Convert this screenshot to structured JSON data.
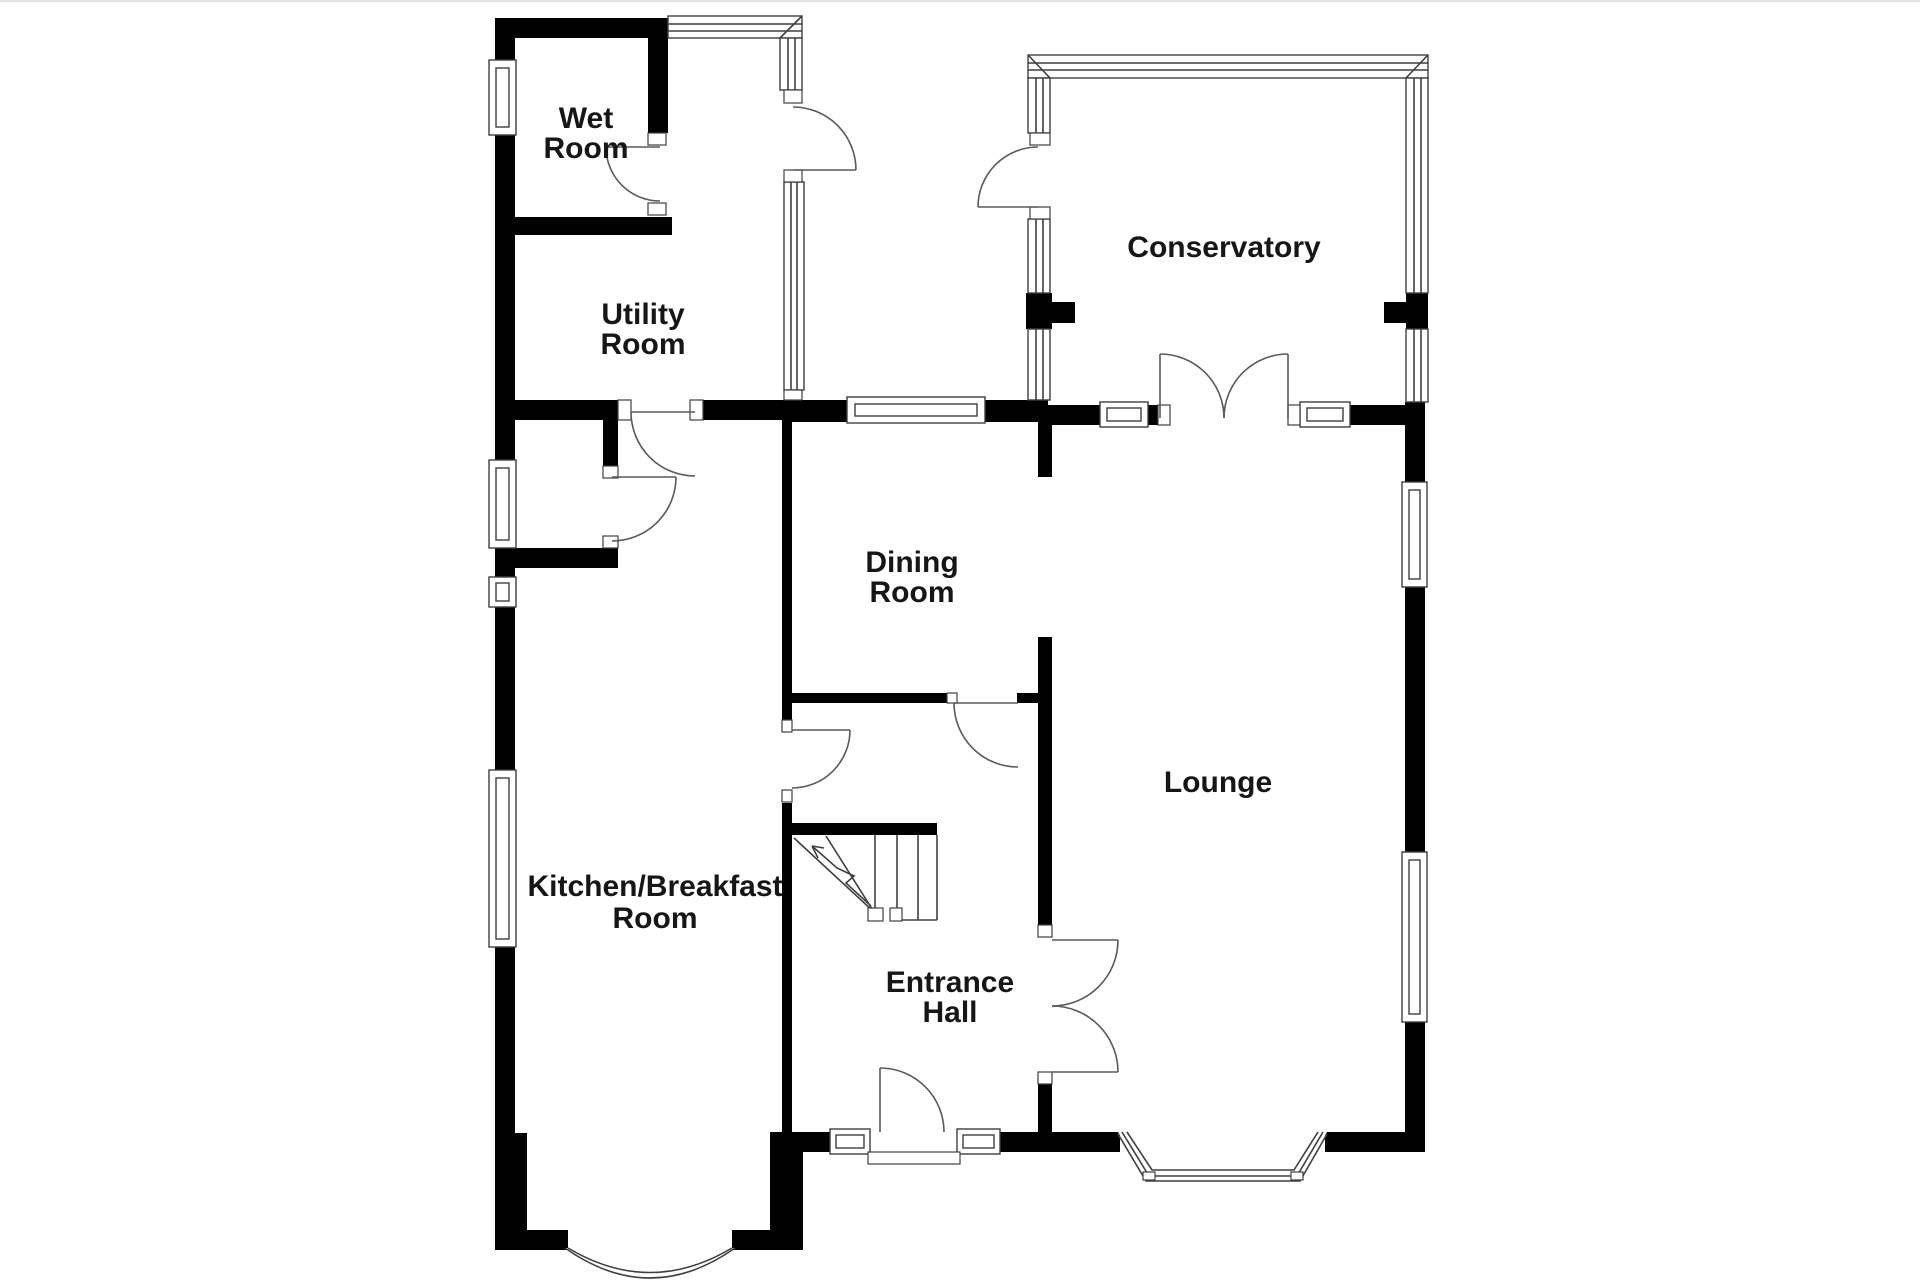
{
  "rooms": {
    "wet_room": {
      "line1": "Wet",
      "line2": "Room"
    },
    "utility_room": {
      "line1": "Utility",
      "line2": "Room"
    },
    "conservatory": {
      "line1": "Conservatory"
    },
    "dining_room": {
      "line1": "Dining",
      "line2": "Room"
    },
    "lounge": {
      "line1": "Lounge"
    },
    "kitchen": {
      "line1": "Kitchen/Breakfast",
      "line2": "Room"
    },
    "entrance_hall": {
      "line1": "Entrance",
      "line2": "Hall"
    }
  },
  "colors": {
    "wall": "#000000",
    "background": "#ffffff",
    "detail_line": "#3f3f3f",
    "label_text": "#161616"
  }
}
